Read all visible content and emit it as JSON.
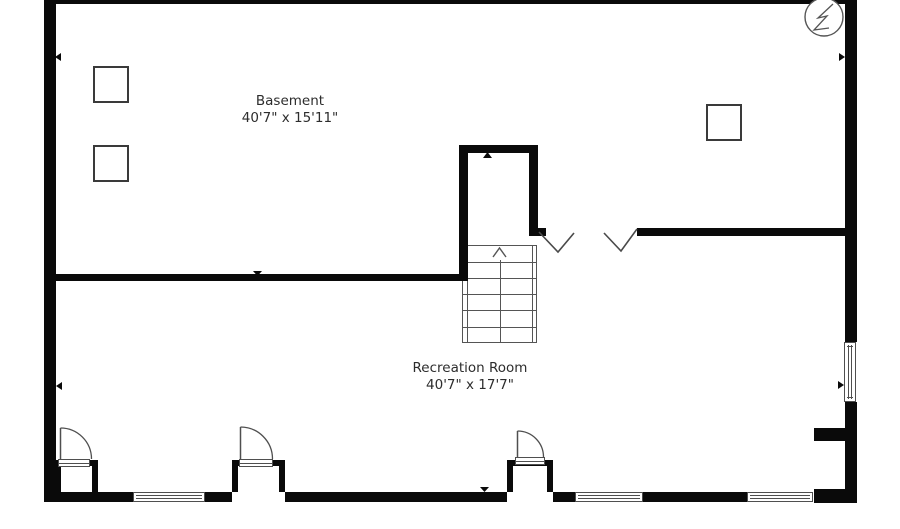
{
  "title": "Basement floor plan",
  "colors": {
    "background": "#ffffff",
    "wall": "#0a0a0a",
    "thin_line": "#4f4f4f",
    "text": "#2d2d2d"
  },
  "rooms": [
    {
      "name": "Basement",
      "dimensions": "40'7\" x 15'11\""
    },
    {
      "name": "Recreation Room",
      "dimensions": "40'7\" x 17'7\""
    }
  ],
  "symbols": {
    "electrical_panel": "circle-lightning-bolt",
    "stairs": "stair-grid-with-up-arrow",
    "door_count": 3,
    "window_count": 4,
    "post_count": 3
  }
}
